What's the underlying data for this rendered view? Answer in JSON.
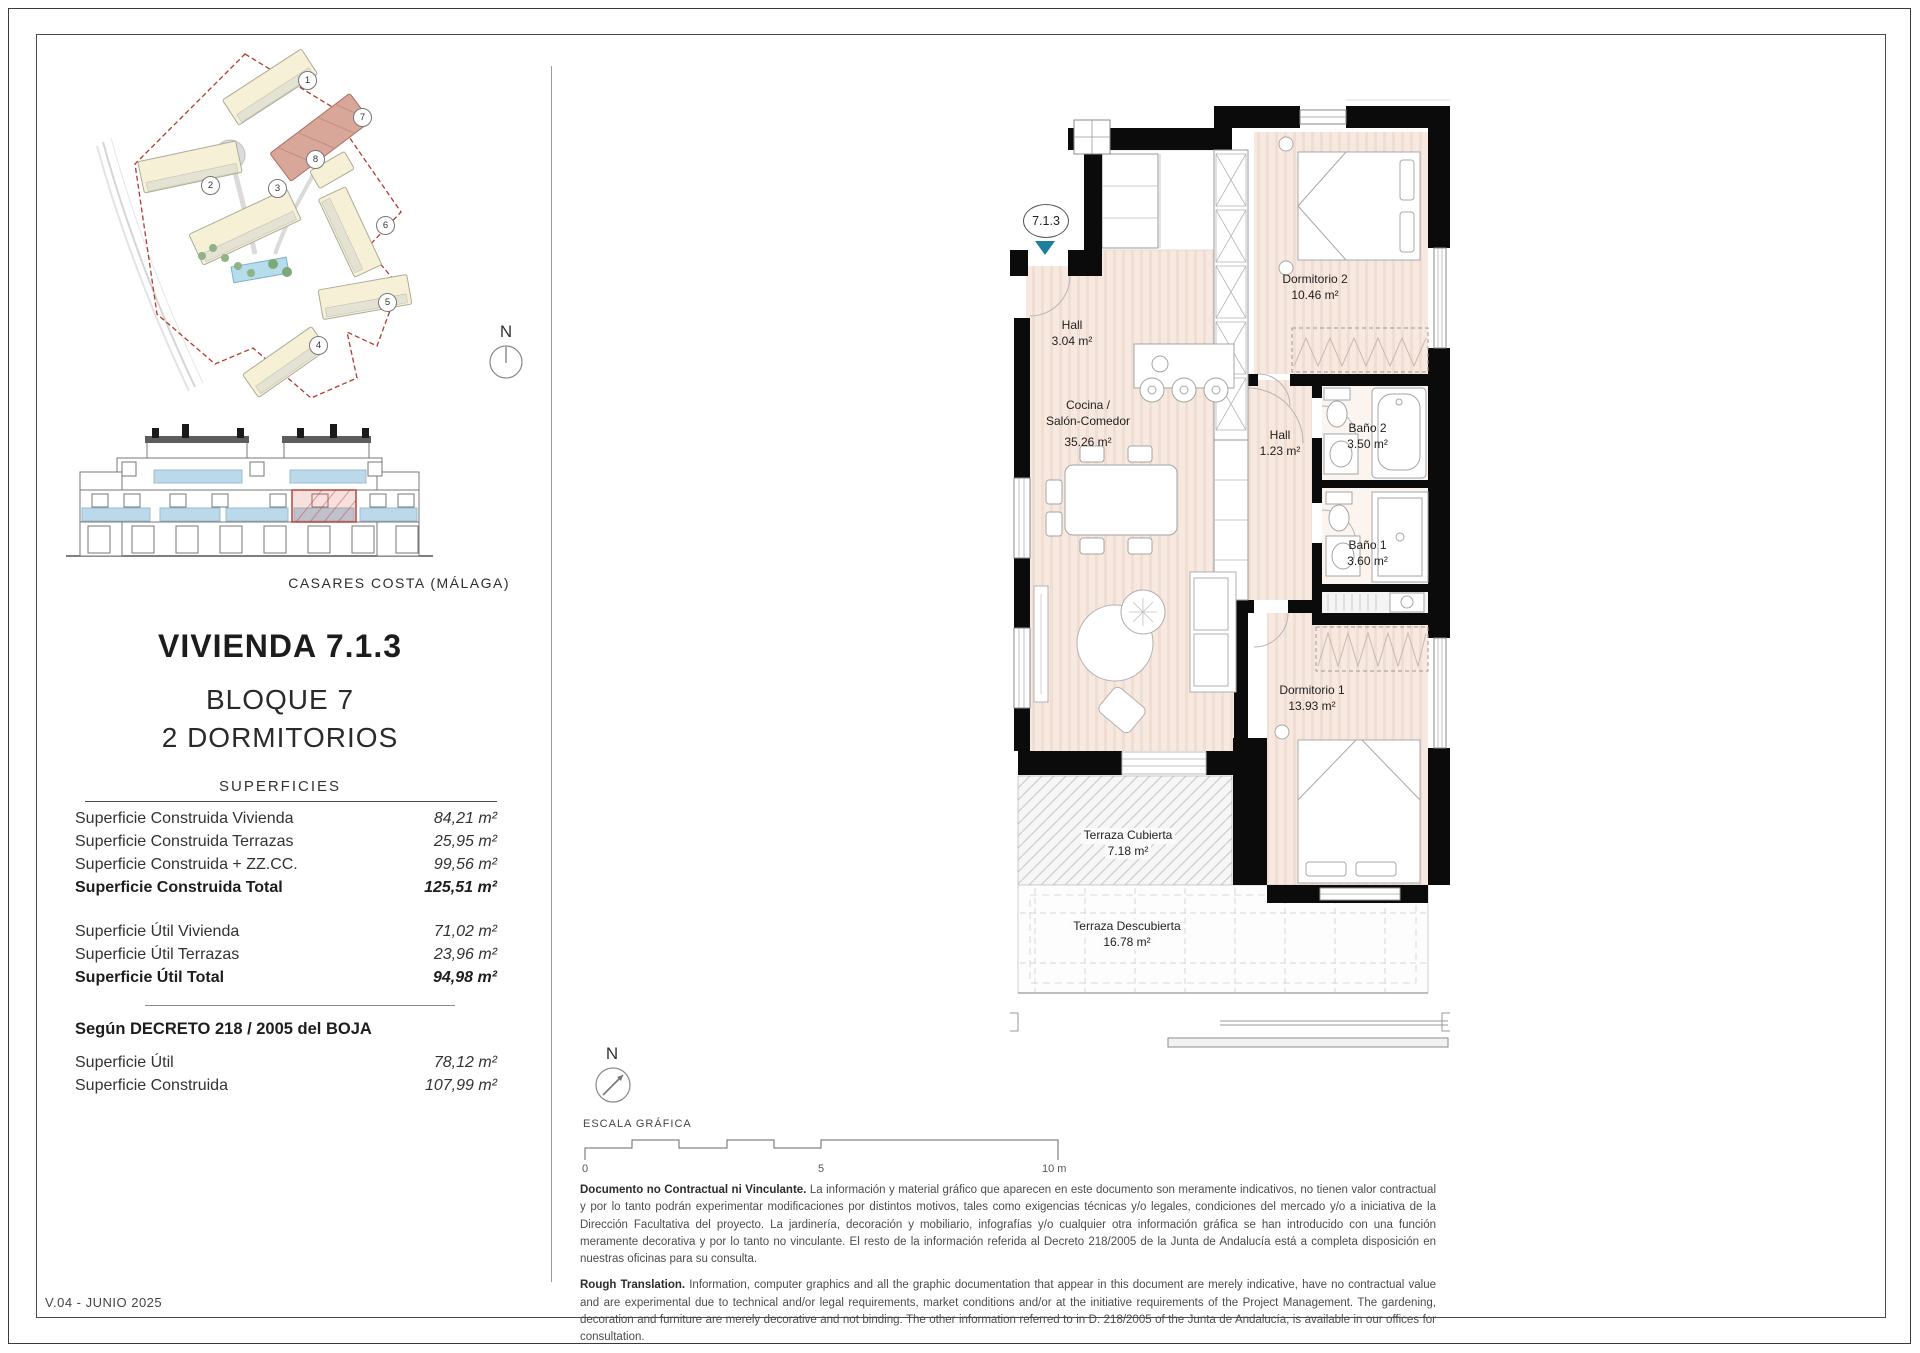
{
  "page": {
    "version": "V.04 - JUNIO 2025",
    "location_caption": "CASARES COSTA (MÁLAGA)"
  },
  "unit": {
    "title": "VIVIENDA 7.1.3",
    "block": "BLOQUE 7",
    "type": "2 DORMITORIOS",
    "code": "7.1.3"
  },
  "surfaces": {
    "heading": "SUPERFICIES",
    "built_rows": [
      {
        "label": "Superficie Construida Vivienda",
        "value": "84,21 m²"
      },
      {
        "label": "Superficie Construida Terrazas",
        "value": "25,95 m²"
      },
      {
        "label": "Superficie Construida + ZZ.CC.",
        "value": "99,56 m²"
      },
      {
        "label": "Superficie Construida Total",
        "value": "125,51 m²"
      }
    ],
    "useful_rows": [
      {
        "label": "Superficie Útil Vivienda",
        "value": "71,02 m²"
      },
      {
        "label": "Superficie Útil Terrazas",
        "value": "23,96 m²"
      },
      {
        "label": "Superficie Útil Total",
        "value": "94,98 m²"
      }
    ],
    "decree_heading": "Según DECRETO 218 / 2005 del BOJA",
    "decree_rows": [
      {
        "label": "Superficie Útil",
        "value": "78,12 m²"
      },
      {
        "label": "Superficie Construida",
        "value": "107,99 m²"
      }
    ]
  },
  "site_plan": {
    "building_numbers": [
      "1",
      "2",
      "3",
      "4",
      "5",
      "6",
      "7",
      "8"
    ],
    "highlighted_building": "7"
  },
  "compass": {
    "north": "N"
  },
  "floor_plan": {
    "unit_tag": "7.1.3",
    "rooms": [
      {
        "line1": "Hall",
        "area": "3.04 m²"
      },
      {
        "line1": "Cocina /",
        "line2": "Salón-Comedor",
        "area": "35.26 m²"
      },
      {
        "line1": "Dormitorio 2",
        "area": "10.46 m²"
      },
      {
        "line1": "Hall",
        "area": "1.23 m²"
      },
      {
        "line1": "Baño 2",
        "area": "3.50 m²"
      },
      {
        "line1": "Baño 1",
        "area": "3.60 m²"
      },
      {
        "line1": "Dormitorio 1",
        "area": "13.93 m²"
      },
      {
        "line1": "Terraza Cubierta",
        "area": "7.18 m²"
      },
      {
        "line1": "Terraza Descubierta",
        "area": "16.78 m²"
      }
    ]
  },
  "scale_bar": {
    "label": "ESCALA GRÁFICA",
    "tick0": "0",
    "tick5": "5",
    "tick10": "10 m"
  },
  "disclaimer": {
    "es_lead": "Documento no Contractual ni Vinculante.",
    "es_body": " La información y material gráfico que aparecen en este documento son meramente indicativos, no tienen valor contractual y por lo tanto podrán experimentar modificaciones por distintos motivos, tales como exigencias técnicas y/o legales, condiciones del mercado y/o a iniciativa de la Dirección Facultativa del proyecto. La jardinería, decoración y mobiliario, infografías y/o cualquier otra información gráfica se han introducido con una función meramente decorativa y por lo tanto no vinculante. El resto de la información referida al Decreto 218/2005 de la Junta de Andalucía está a completa disposición en nuestras oficinas para su consulta.",
    "en_lead": "Rough Translation.",
    "en_body": " Information, computer graphics and all the graphic documentation that appear in this document are merely indicative, have no contractual value and are experimental due to technical and/or legal requirements, market conditions and/or at the initiative requirements of the Project Management. The gardening, decoration and furniture are merely decorative and not binding. The other information referred to in D. 218/2005 of the Junta de Andalucía, is available in our offices for consultation."
  },
  "colors": {
    "accent_teal": "#1b7f9e",
    "boundary_red": "#b4392c",
    "highlight_salmon": "#d9a79a",
    "glass_blue": "#bcd8eb",
    "floor_pink": "#f8e9e0"
  }
}
